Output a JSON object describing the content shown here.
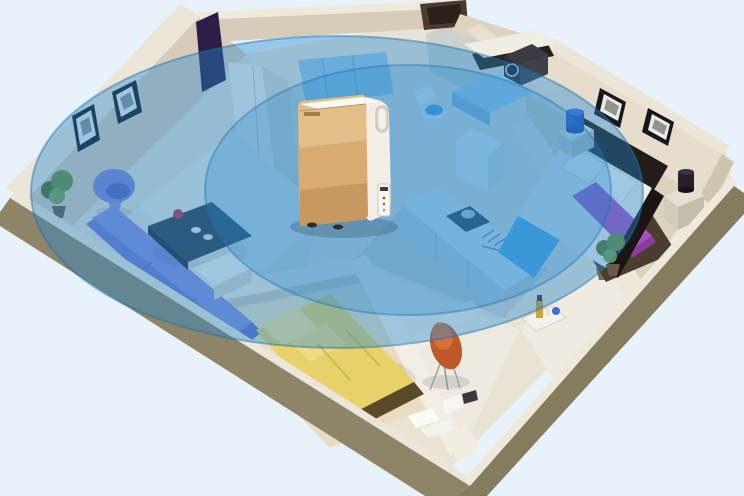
{
  "scene": {
    "description": "3D isometric cutaway of an apartment; a gold air purifier stands in the central hallway with translucent blue concentric ellipses showing whole-home coverage",
    "background": "#e8f2fa",
    "coverage": {
      "color": "#2488cf",
      "edge_color": "#1a6fae",
      "outer_ring": {
        "cx": 337,
        "cy": 192,
        "rx": 306,
        "ry": 156,
        "opacity": 0.4
      },
      "inner_ring": {
        "cx": 408,
        "cy": 190,
        "rx": 203,
        "ry": 125,
        "opacity": 0.28
      }
    },
    "device": {
      "type": "air purifier",
      "front_color": "#d8ab70",
      "front_highlight": "#f0d7a8",
      "side_color": "#f2eee5",
      "panel": "side control display",
      "position": "center hallway"
    },
    "palette": {
      "exterior_wall": "#8e8569",
      "exterior_wall_dark": "#857b5e",
      "wall_top": "#ece6d8",
      "interior_wall": "#d9cbb9",
      "interior_wall_light": "#eee8db",
      "floor": "#e9e3d6",
      "rug": "#e8e8e2",
      "sofa": "#7279cf",
      "egg_chair": "#7f84d6",
      "coffee_table": "#2f3e4c",
      "flower_red": "#c22f4e",
      "bed_yellow": "#e7d168",
      "pillow_yellow": "#f2e28c",
      "chair_orange": "#bf5a28",
      "bed_runner": "#a852c0",
      "blanket_blue": "#59b0e6",
      "lamp_blue": "#2f4fb8",
      "plant_green": "#6d8f3c",
      "counter": "#e3ecf0",
      "dark_panel": "#2c1e46",
      "headboard": "#231c18"
    },
    "rooms": [
      {
        "name": "living room",
        "items": [
          "purple egg chair",
          "purple sofa",
          "dark coffee table with red flowers",
          "area rug",
          "two wall pictures",
          "corner plant"
        ]
      },
      {
        "name": "small bedroom",
        "items": [
          "yellow double bed with pillows"
        ]
      },
      {
        "name": "study corner",
        "items": [
          "orange designer chair",
          "papers and books on floor"
        ]
      },
      {
        "name": "kitchen",
        "items": [
          "counter with stove and pot",
          "dish rack",
          "sink with faucet",
          "white cabinet",
          "corner plant"
        ]
      },
      {
        "name": "bathroom",
        "items": [
          "toilet with blue lid",
          "blue vanity tub",
          "washing machine in niche",
          "wall shelf"
        ]
      },
      {
        "name": "master bedroom",
        "items": [
          "double bed with purple runner and blue blanket",
          "two nightstands with lamps",
          "two wall pictures",
          "corner plant"
        ]
      },
      {
        "name": "entry hall",
        "items": [
          "tray with bottles"
        ]
      }
    ]
  }
}
